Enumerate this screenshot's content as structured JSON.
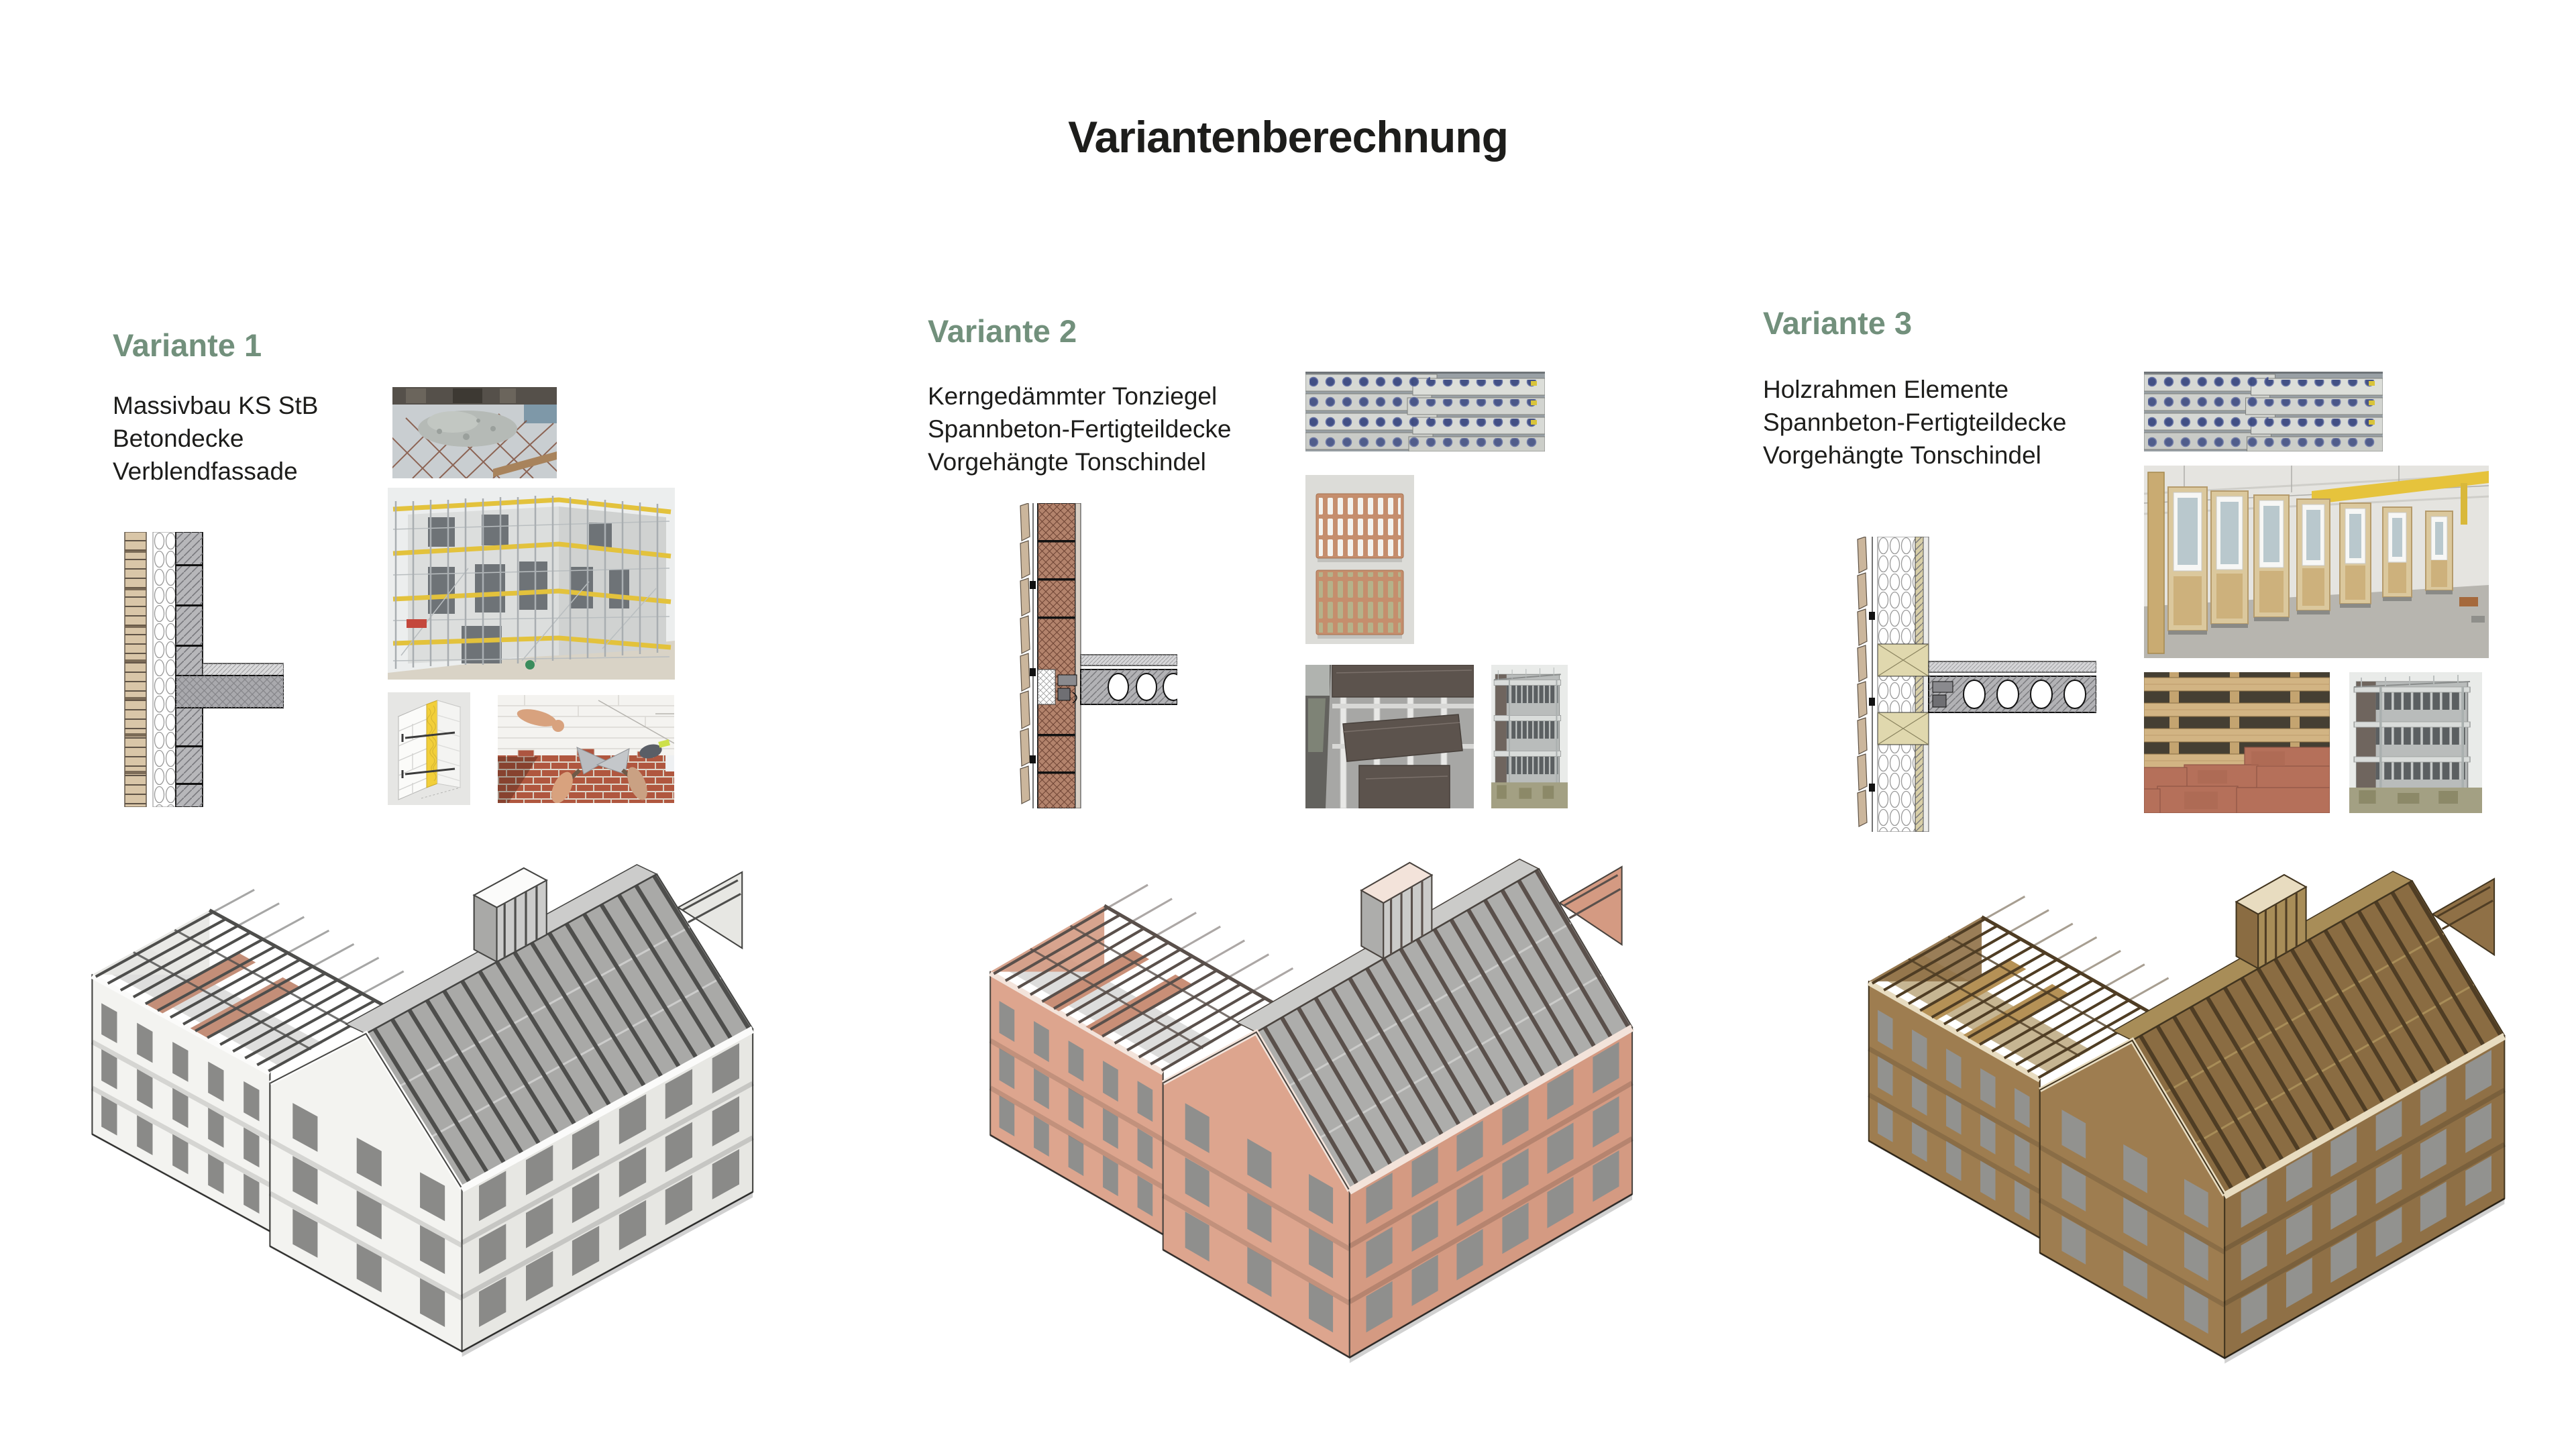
{
  "title": "Variantenberechnung",
  "theme": {
    "background": "#ffffff",
    "heading": "#72907c",
    "text": "#1d1d1b"
  },
  "variants": [
    {
      "heading": "Variante 1",
      "description_lines": [
        "Massivbau KS StB",
        "Betondecke",
        "Verblendfassade"
      ],
      "figures": [
        "wall-section-drawing-masonry",
        "concrete-slab-pour-photo",
        "shell-construction-scaffolding-photo",
        "cavity-wall-insulation-diagram",
        "bricklaying-photo",
        "axonometric-building-render-white"
      ],
      "render": {
        "wall": "#f3f3f0",
        "wall2": "#e7e7e3",
        "roof": "#a9a9a7",
        "roof2": "#cccccb",
        "rafter": "#4e4e4c",
        "win": "#8a8a88",
        "edge": "#454543",
        "accent": "#c38e78",
        "frame": "#fbfbfa"
      }
    },
    {
      "heading": "Variante 2",
      "description_lines": [
        "Kerngedämmter Tonziegel",
        "Spannbeton-Fertigteildecke",
        "Vorgehängte Tonschindel"
      ],
      "figures": [
        "wall-section-drawing-clay-block",
        "hollow-core-slab-stack-photo",
        "clay-shingle-samples-photo",
        "shingle-facade-mockup-photo",
        "balcony-facade-photo",
        "axonometric-building-render-terracotta"
      ],
      "render": {
        "wall": "#dda58e",
        "wall2": "#d49a82",
        "roof": "#adadab",
        "roof2": "#cbcbc9",
        "rafter": "#5a504b",
        "win": "#8f8f8d",
        "edge": "#4a443f",
        "accent": "#c98f77",
        "frame": "#f3e3da"
      }
    },
    {
      "heading": "Variante 3",
      "description_lines": [
        "Holzrahmen Elemente",
        "Spannbeton-Fertigteildecke",
        "Vorgehängte Tonschindel"
      ],
      "figures": [
        "wall-section-drawing-timber-frame",
        "hollow-core-slab-stack-photo",
        "timber-frame-factory-photo",
        "timber-battens-clay-tiles-photo",
        "balcony-facade-photo",
        "axonometric-building-render-timber"
      ],
      "render": {
        "wall": "#9e7d50",
        "wall2": "#8f7046",
        "roof": "#8a6c42",
        "roof2": "#a88d58",
        "rafter": "#4f3d24",
        "win": "#92928f",
        "edge": "#42351f",
        "accent": "#b59156",
        "frame": "#e8dcc0"
      }
    }
  ]
}
